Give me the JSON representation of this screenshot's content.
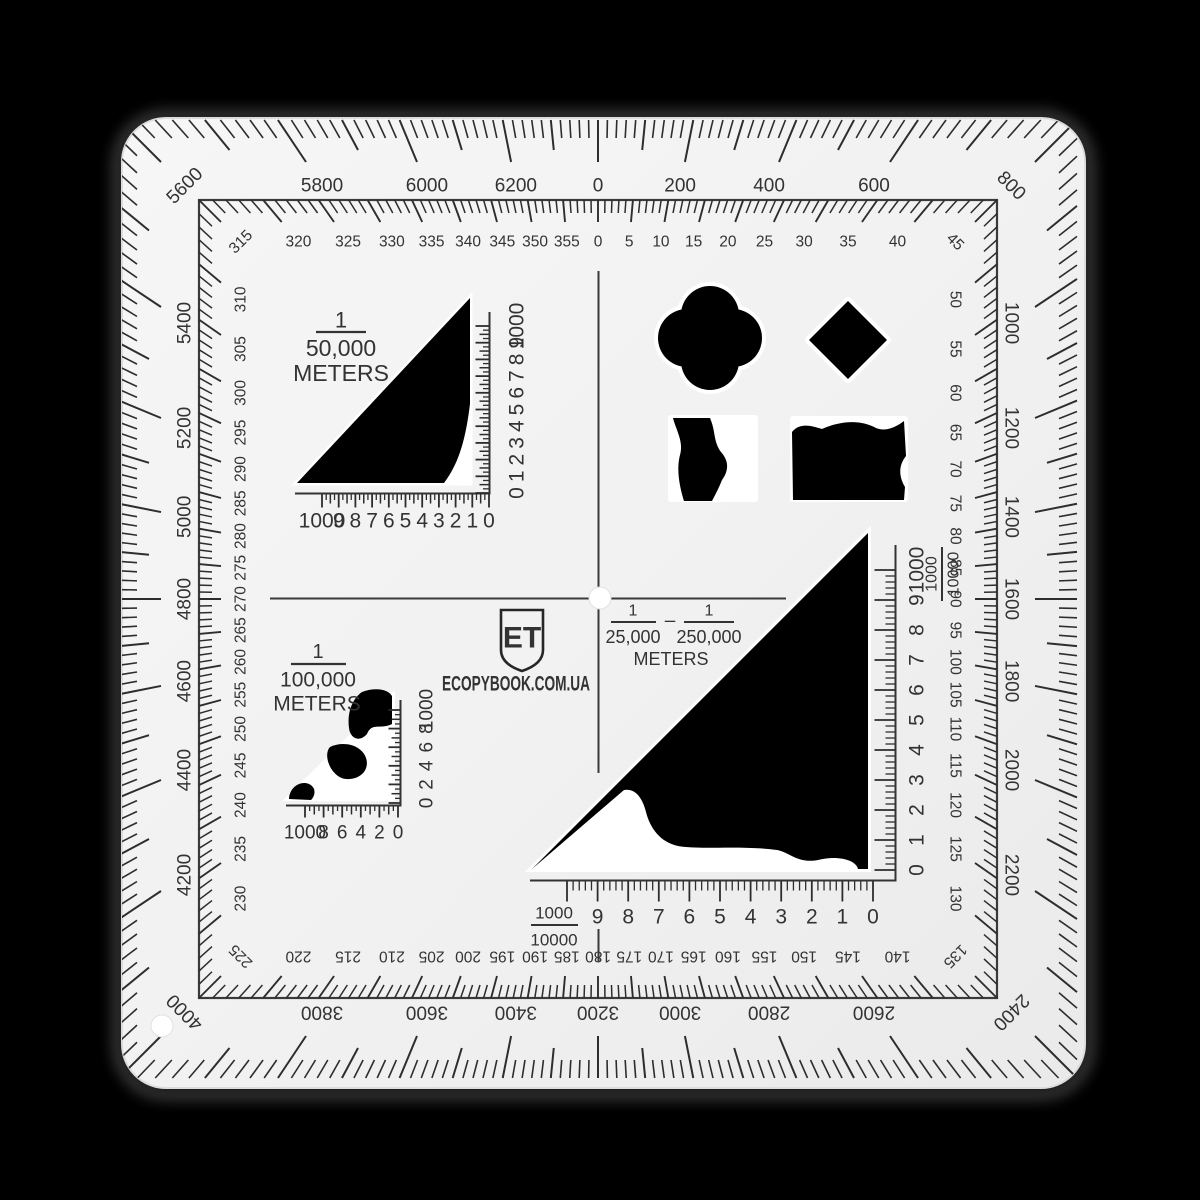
{
  "device": {
    "type_label": "square map protractor coordinate scale",
    "brand_logo": "ET",
    "website": "ECOPYBOOK.COM.UA"
  },
  "colors": {
    "background": "#000000",
    "body": "#f1f1f1",
    "ink": "#333333",
    "tick": "#2d2d2d",
    "cutout": "#000000",
    "matte": "#ffffff"
  },
  "mils_ring": {
    "label_step": 200,
    "full_circle": 6400,
    "labels": [
      "0",
      "200",
      "400",
      "600",
      "800",
      "1000",
      "1200",
      "1400",
      "1600",
      "1800",
      "2000",
      "2200",
      "2400",
      "2600",
      "2800",
      "3000",
      "3200",
      "3400",
      "3600",
      "3800",
      "4000",
      "4200",
      "4400",
      "4600",
      "4800",
      "5000",
      "5200",
      "5400",
      "5600",
      "5800",
      "6000",
      "6200"
    ]
  },
  "degree_ring": {
    "label_step": 5,
    "labels": [
      "0",
      "5",
      "10",
      "15",
      "20",
      "25",
      "30",
      "35",
      "40",
      "45",
      "50",
      "55",
      "60",
      "65",
      "70",
      "75",
      "80",
      "85",
      "90",
      "95",
      "100",
      "105",
      "110",
      "115",
      "120",
      "125",
      "130",
      "135",
      "140",
      "145",
      "150",
      "155",
      "160",
      "165",
      "170",
      "175",
      "180",
      "185",
      "190",
      "195",
      "200",
      "205",
      "210",
      "215",
      "220",
      "225",
      "230",
      "235",
      "240",
      "245",
      "250",
      "255",
      "260",
      "265",
      "270",
      "275",
      "280",
      "285",
      "290",
      "295",
      "300",
      "305",
      "310",
      "315",
      "320",
      "325",
      "330",
      "335",
      "340",
      "345",
      "350",
      "355"
    ]
  },
  "scale_50k": {
    "fraction_numerator": "1",
    "fraction_denominator": "50,000",
    "unit_label": "METERS",
    "horizontal_labels_left_to_right": [
      "1000",
      "9",
      "8",
      "7",
      "6",
      "5",
      "4",
      "3",
      "2",
      "1",
      "0"
    ],
    "vertical_labels_bottom_to_top": [
      "0",
      "1",
      "2",
      "3",
      "4",
      "5",
      "6",
      "7",
      "8",
      "9",
      "1000"
    ]
  },
  "scale_100k": {
    "fraction_numerator": "1",
    "fraction_denominator": "100,000",
    "unit_label": "METERS",
    "horizontal_labels_left_to_right": [
      "1000",
      "8",
      "6",
      "4",
      "2",
      "0"
    ],
    "vertical_labels_bottom_to_top": [
      "0",
      "2",
      "4",
      "6",
      "8",
      "1000"
    ]
  },
  "scale_25k_250k": {
    "fraction1_numerator": "1",
    "fraction1_denominator": "25,000",
    "separator": "–",
    "fraction2_numerator": "1",
    "fraction2_denominator": "250,000",
    "unit_label": "METERS"
  },
  "scale_10k": {
    "horizontal_fraction_numerator": "1000",
    "horizontal_fraction_denominator": "10000",
    "vertical_fraction_numerator": "1000",
    "vertical_fraction_denominator": "10000",
    "horizontal_labels_left_to_right": [
      "9",
      "8",
      "7",
      "6",
      "5",
      "4",
      "3",
      "2",
      "1",
      "0"
    ],
    "vertical_labels_bottom_to_top": [
      "0",
      "1",
      "2",
      "3",
      "4",
      "5",
      "6",
      "7",
      "8",
      "9",
      "1000"
    ]
  }
}
